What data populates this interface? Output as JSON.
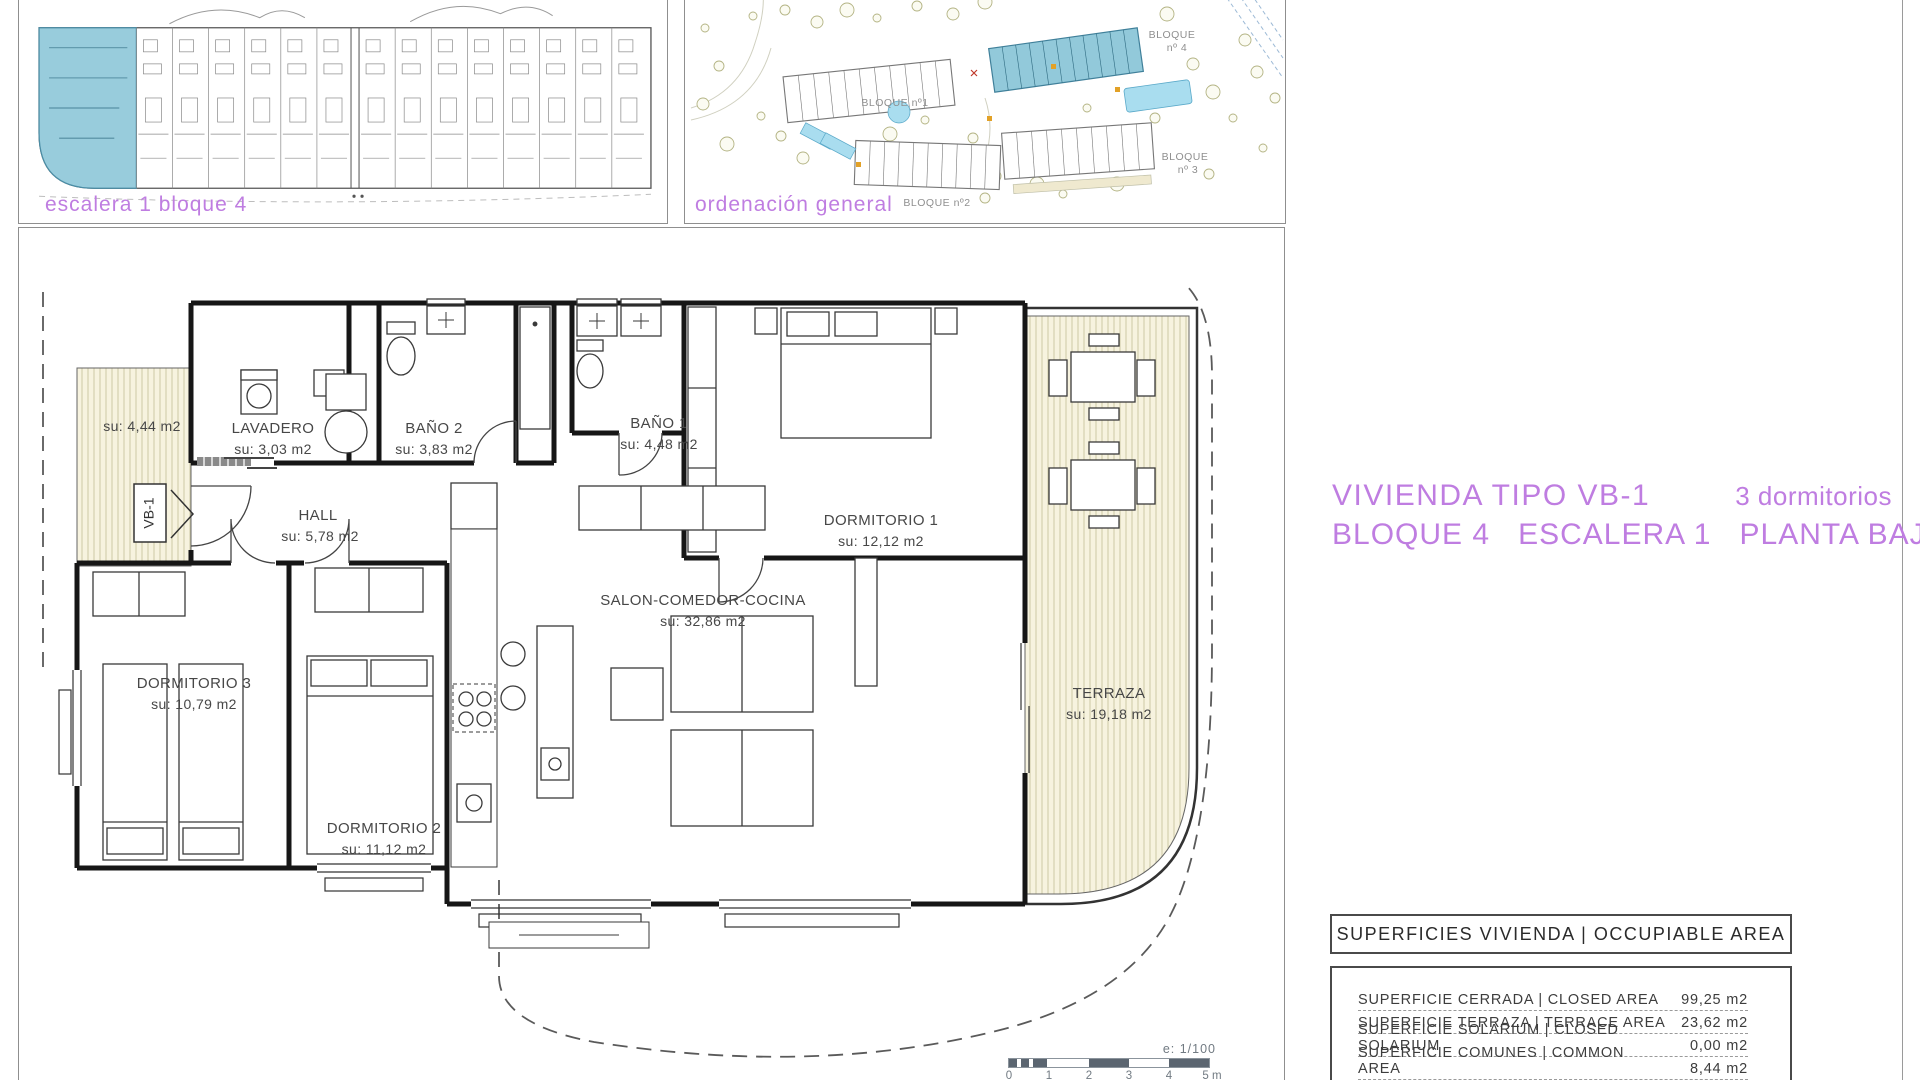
{
  "colors": {
    "accent_purple": "#bf7de1",
    "highlight_blue": "#92c9da",
    "hatch_bg": "#f7f3df",
    "wall": "#161616",
    "scalebar": "#5b6570"
  },
  "key_plan": {
    "label": "escalera 1 bloque 4"
  },
  "site_plan": {
    "label": "ordenación general",
    "block1": "BLOQUE nº1",
    "block2": "BLOQUE nº2",
    "block3_line1": "BLOQUE",
    "block3_line2": "nº 3",
    "block4_line1": "BLOQUE",
    "block4_line2": "nº 4"
  },
  "title": {
    "name": "VIVIENDA TIPO VB-1",
    "bedrooms": "3 dormitorios",
    "line2": "BLOQUE 4   ESCALERA 1   PLANTA BAJA"
  },
  "floor_plan": {
    "entry_marker": "VB-1",
    "entry_terrace_area": "su: 4,44 m2",
    "rooms": [
      {
        "name": "LAVADERO",
        "area": "su: 3,03 m2"
      },
      {
        "name": "BAÑO 2",
        "area": "su: 3,83 m2"
      },
      {
        "name": "BAÑO 1",
        "area": "su: 4,48 m2"
      },
      {
        "name": "DORMITORIO 1",
        "area": "su: 12,12 m2"
      },
      {
        "name": "HALL",
        "area": "su: 5,78 m2"
      },
      {
        "name": "SALON-COMEDOR-COCINA",
        "area": "su: 32,86 m2"
      },
      {
        "name": "DORMITORIO 3",
        "area": "su: 10,79 m2"
      },
      {
        "name": "DORMITORIO 2",
        "area": "su: 11,12 m2"
      },
      {
        "name": "TERRAZA",
        "area": "su: 19,18 m2"
      }
    ]
  },
  "areas_table": {
    "header": "SUPERFICIES VIVIENDA | OCCUPIABLE AREA",
    "rows": [
      {
        "label": "SUPERFICIE CERRADA | CLOSED AREA",
        "value": "99,25 m2"
      },
      {
        "label": "SUPERFICIE TERRAZA   | TERRACE AREA",
        "value": "23,62 m2"
      },
      {
        "label": "SUPERFICIE SOLARIUM | CLOSED SOLARIUM",
        "value": "0,00 m2"
      },
      {
        "label": "SUPERFICIE COMUNES | COMMON AREA",
        "value": "8,44 m2"
      }
    ]
  },
  "scale_bar": {
    "label": "e: 1/100",
    "ticks": [
      "0",
      "1",
      "2",
      "3",
      "4",
      "5 m"
    ]
  }
}
